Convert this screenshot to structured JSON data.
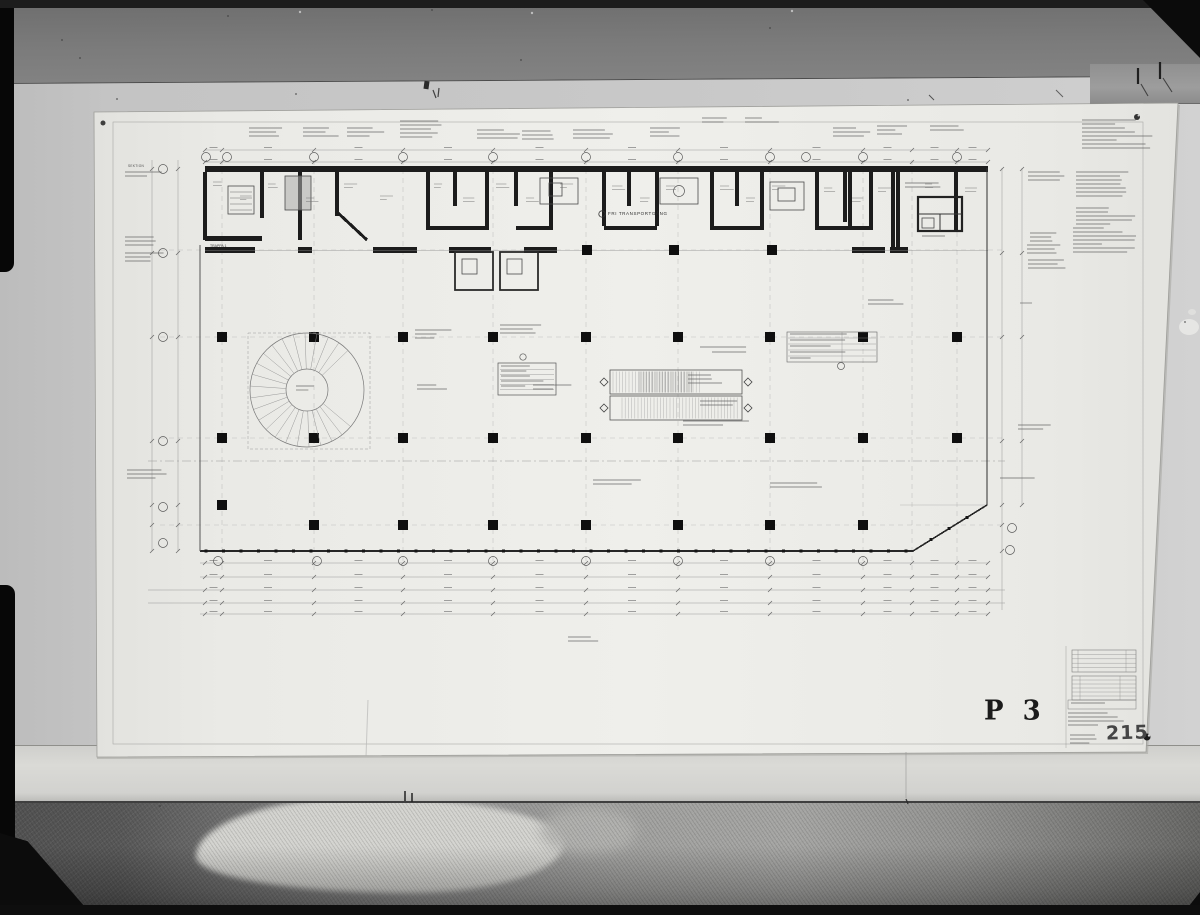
{
  "sheet": {
    "code": "P 3",
    "archive_number": "215",
    "corridor_label": "FRI TRANSPORTGÅNG",
    "stair_label": "TRAPPA 1",
    "section_label": "SEKTION"
  },
  "colors": {
    "ink": "#1c1c1c",
    "paper": "#eaeae6",
    "wall": "#c6c6c6",
    "carpet": "#6e6e6e",
    "film_edge": "#070707"
  }
}
